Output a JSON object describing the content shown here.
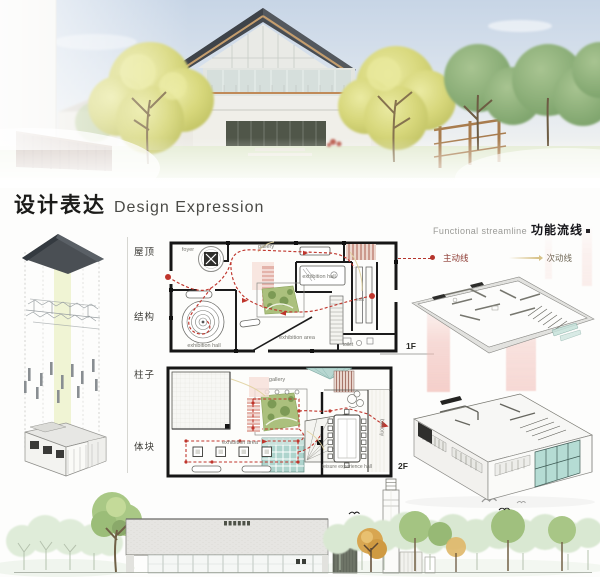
{
  "header": {
    "title_cn": "设计表达",
    "title_en": "Design Expression"
  },
  "streamline": {
    "caption_en": "Functional streamline",
    "caption_cn": "功能流线",
    "primary_label": "主动线",
    "secondary_label": "次动线",
    "primary_color": "#b5342c",
    "secondary_color": "#d7c186"
  },
  "exploded": {
    "layers": [
      {
        "label": "屋顶"
      },
      {
        "label": "结构"
      },
      {
        "label": "柱子"
      },
      {
        "label": "体块"
      }
    ]
  },
  "plan_1f": {
    "level_label": "1F",
    "rooms": {
      "foyer": "foyer",
      "gallery": "gallery",
      "exhibition_hall_upper": "exhibition hall",
      "exit": "exit",
      "exhibition_area": "exhibition area",
      "exhibition_hall_lower": "exhibition hall",
      "toilet": "toilet"
    }
  },
  "plan_2f": {
    "level_label": "2F",
    "rooms": {
      "gallery": "gallery",
      "exhibition_area": "exhibition area",
      "balcony": "balcony",
      "leisure_hall": "leisure experience hall"
    }
  },
  "colors": {
    "primary_route": "#bf352c",
    "secondary_route": "#e0d29e",
    "courtyard_green": "#abc07d",
    "glass_teal": "#aed4cd",
    "stair_pink": "#e4b3aa",
    "roof_dark": "#4a4f54",
    "tree_yellow": "#d7d77b"
  }
}
